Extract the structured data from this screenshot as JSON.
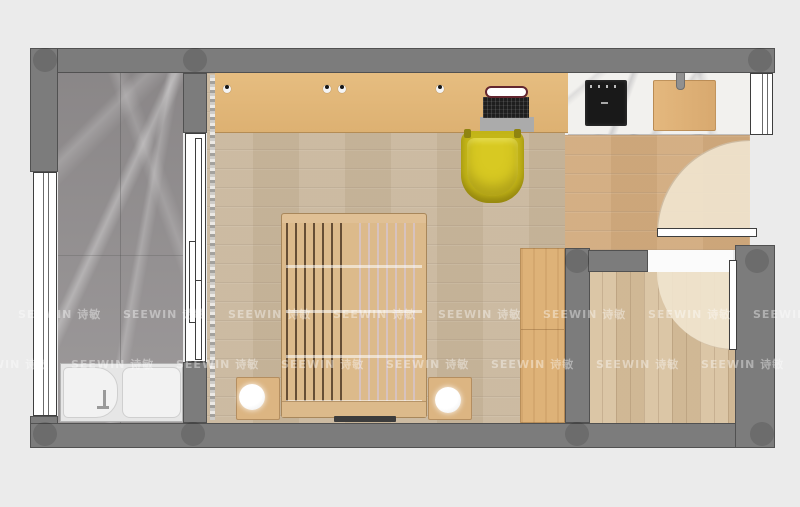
{
  "watermark": {
    "text": "SEEWIN 诗敏"
  },
  "palette": {
    "background": "#ebebeb",
    "wall_gray": "#7c7c7c",
    "marble_floor_gray": "#9a9798",
    "wood_floor_tan": "#c9b79d",
    "corridor_wood": "#d2ab7e",
    "room2_wood": "#d7bf9c",
    "desk_wood_orange": "#e3b97b",
    "cabinet_wood": "#deb278",
    "bed_frame_tan": "#dcba8b",
    "chair_yellow": "#d2c41f",
    "counter_marble_white": "#f2f1ee",
    "cooktop_black": "#191919",
    "fixture_white": "#ffffff"
  }
}
